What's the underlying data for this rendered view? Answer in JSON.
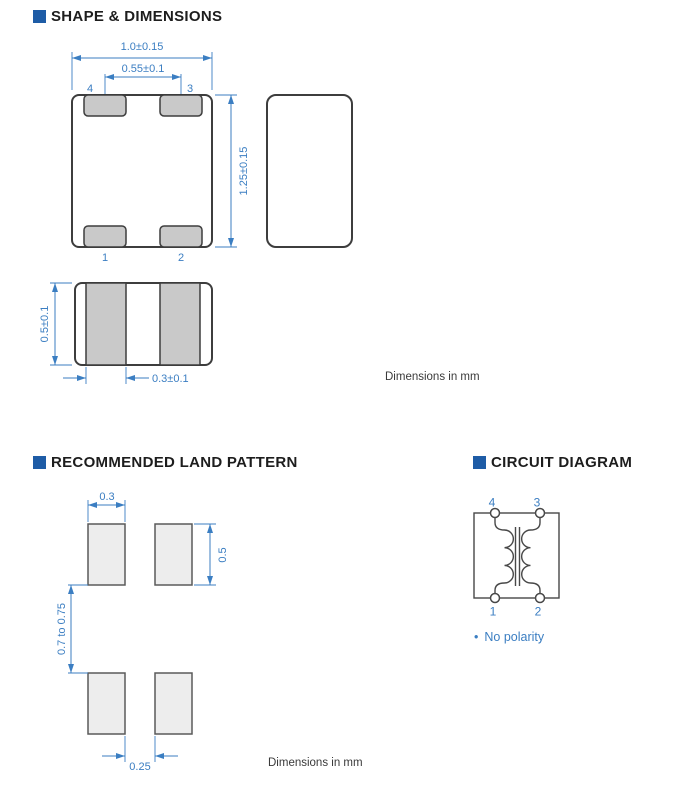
{
  "shape_section": {
    "title": "SHAPE & DIMENSIONS",
    "dims": {
      "width": "1.0±0.15",
      "terminal_pitch": "0.55±0.1",
      "length": "1.25±0.15",
      "height": "0.5±0.1",
      "terminal_width": "0.3±0.1"
    },
    "terminals": {
      "t1": "1",
      "t2": "2",
      "t3": "3",
      "t4": "4"
    },
    "note": "Dimensions in mm"
  },
  "land_section": {
    "title": "RECOMMENDED LAND PATTERN",
    "dims": {
      "pad_width": "0.3",
      "pad_height": "0.5",
      "pad_row_gap": "0.7 to 0.75",
      "pad_col_gap": "0.25"
    },
    "note": "Dimensions in mm"
  },
  "circuit_section": {
    "title": "CIRCUIT DIAGRAM",
    "terminals": {
      "t1": "1",
      "t2": "2",
      "t3": "3",
      "t4": "4"
    },
    "note_bullet": "•",
    "note": "No polarity"
  },
  "colors": {
    "accent_blue": "#3b7ec2",
    "header_square_blue": "#1e5ca6",
    "terminal_gray": "#c9c9c9",
    "land_pad_gray": "#ededed"
  }
}
